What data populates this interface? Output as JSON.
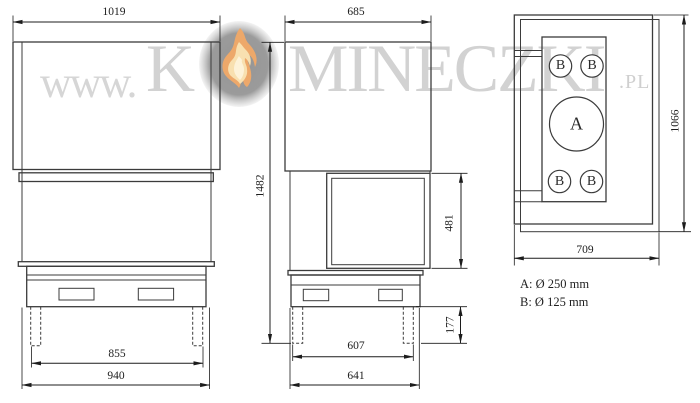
{
  "watermark": {
    "prefix": "www.",
    "brand_first": "K",
    "brand_rest": "MINECZKI",
    "tld": ".pl"
  },
  "front_view": {
    "dim_top_width": "1019",
    "dim_feet_span": "855",
    "dim_base_width": "940"
  },
  "side_view": {
    "dim_top_depth": "685",
    "dim_total_height": "1482",
    "dim_glass_height": "481",
    "dim_plinth_height": "177",
    "dim_feet_span": "607",
    "dim_base_depth": "641"
  },
  "top_view": {
    "dim_width": "709",
    "dim_depth": "1066",
    "outlets": [
      "B",
      "B",
      "A",
      "B",
      "B"
    ]
  },
  "legend": {
    "outlet_a": "A: Ø 250 mm",
    "outlet_b": "B: Ø 125 mm"
  },
  "colors": {
    "line": "#3b3b3b",
    "dimension": "#1c1c1c",
    "watermark_gray": "#d2d2d2",
    "flame_badge_gray": "#9a9a9a",
    "flame_peach": "#eda86a",
    "flame_cream": "#f8e0b0"
  }
}
